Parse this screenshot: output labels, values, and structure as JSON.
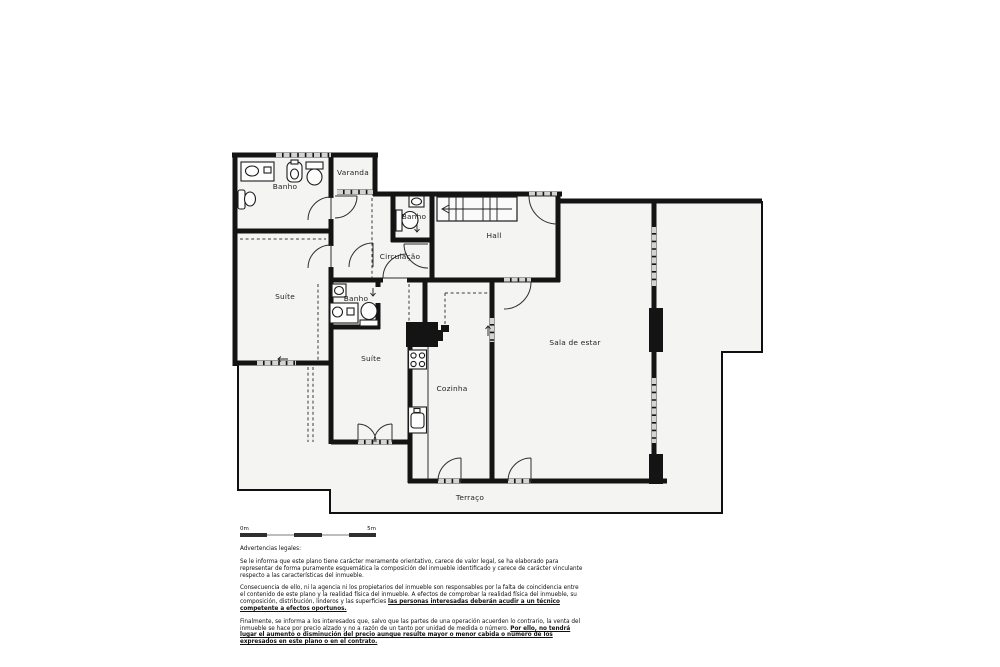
{
  "plan": {
    "rooms": {
      "banho1": "Banho",
      "varanda": "Varanda",
      "banho2": "Banho",
      "hall": "Hall",
      "circulacao": "Circulação",
      "suite1": "Suíte",
      "banho3": "Banho",
      "suite2": "Suíte",
      "cozinha": "Cozinha",
      "sala": "Sala de estar",
      "terraco": "Terraço"
    },
    "colors": {
      "wall": "#141414",
      "floor": "#f4f4f2",
      "window": "#d3d3d1",
      "background": "#ffffff"
    }
  },
  "scale_bar": {
    "start": "0m",
    "end": "5m"
  },
  "legal": {
    "heading": "Advertencias legales:",
    "p1": "Se le informa que este plano tiene carácter meramente orientativo, carece de valor legal, se ha elaborado para representar de forma puramente esquemática la composición del inmueble identificado y carece de carácter vinculante respecto a las características del inmueble.",
    "p2": "Consecuencia de ello, ni la agencia ni los propietarios del inmueble son responsables por la falta de coincidencia entre el contenido de este plano y la realidad física del inmueble. A efectos de comprobar la realidad física del inmueble, su composición, distribución, linderos y las superficies ",
    "p2_underline": "las personas interesadas deberán acudir a un técnico competente a efectos oportunos.",
    "p3": "Finalmente, se informa a los interesados que, salvo que las partes de una operación acuerden lo contrario, la venta del inmueble se hace por precio alzado y no a razón de un tanto por unidad de medida o número. ",
    "p3_underline": "Por ello, no tendrá lugar el aumento o disminución del precio aunque resulte mayor o menor cabida o número de los expresados en este plano o en el contrato."
  }
}
